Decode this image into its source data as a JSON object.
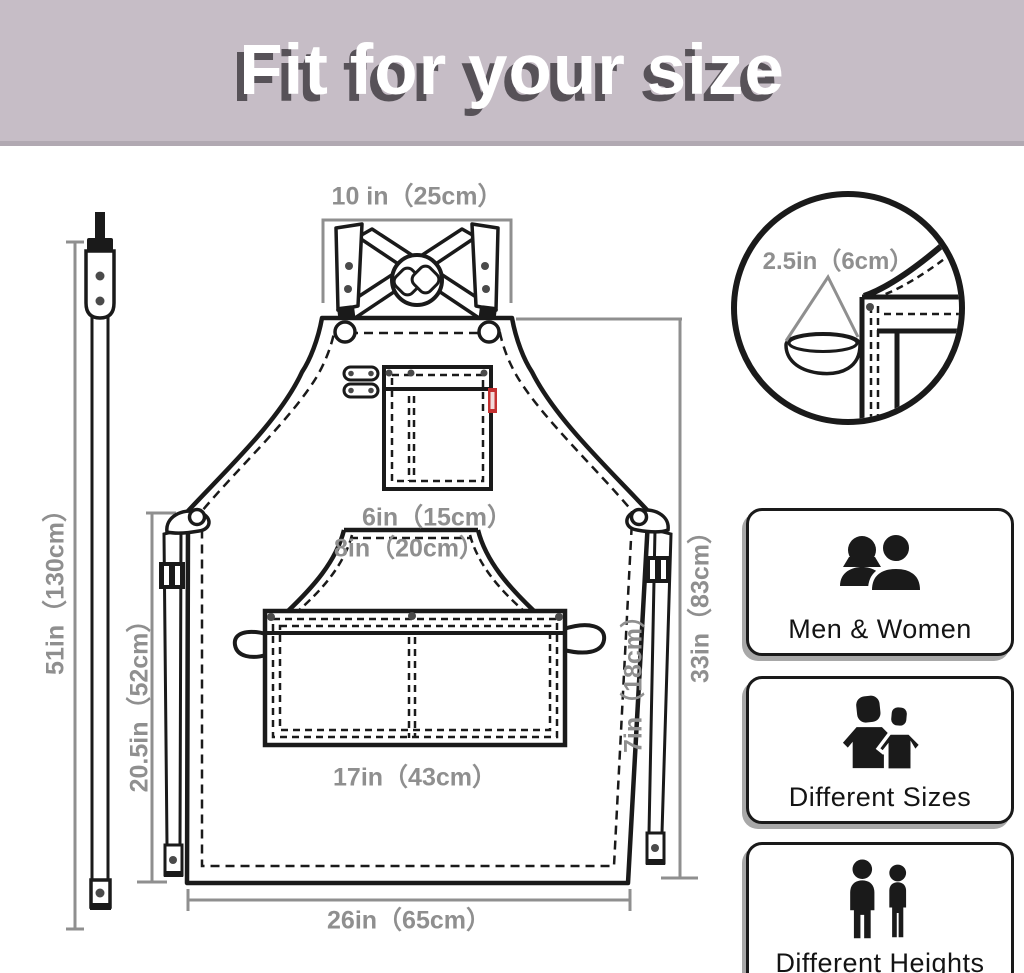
{
  "banner": {
    "title": "Fit for your size"
  },
  "dimensions": {
    "strap_length": "51in（130cm）",
    "top_width": "10 in（25cm）",
    "loop_detail": "2.5in（6cm）",
    "chest_pocket_width": "6in（15cm）",
    "chest_width": "8in（20cm）",
    "waist_pocket_width": "17in（43cm）",
    "waist_pocket_height": "7in（18cm）",
    "body_length": "33in（83cm）",
    "lower_length": "20.5in（52cm）",
    "bottom_width": "26in（65cm）"
  },
  "features": [
    {
      "icon": "men-women-icon",
      "label": "Men & Women"
    },
    {
      "icon": "different-sizes-icon",
      "label": "Different Sizes"
    },
    {
      "icon": "different-heights-icon",
      "label": "Different Heights"
    }
  ],
  "colors": {
    "banner_bg": "#c6bdc6",
    "banner_text": "#ffffff",
    "banner_shadow": "#575258",
    "line": "#1a1a1a",
    "dimension_gray": "#8f8f8f",
    "tag_red": "#c43131"
  }
}
